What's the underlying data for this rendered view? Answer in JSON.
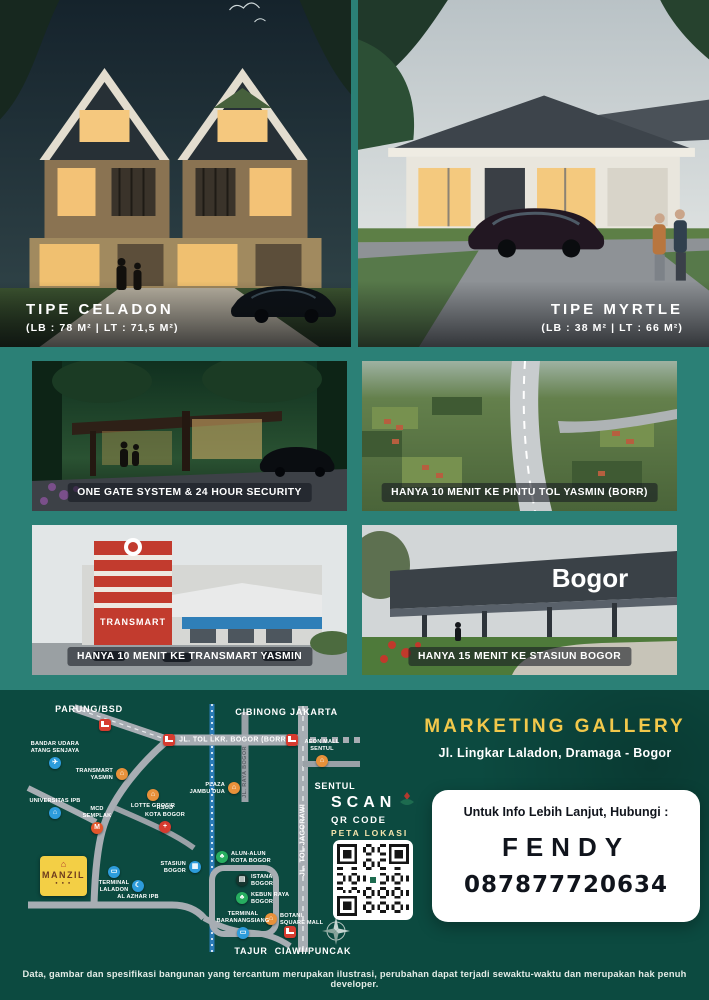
{
  "palette": {
    "teal_bg": "#2b8076",
    "panel_green": "#0c4a40",
    "accent_yellow": "#f2c84b",
    "toll_red": "#d63b2f",
    "poi_orange": "#e8913a",
    "poi_blue": "#2d9cdb",
    "poi_green": "#27ae60"
  },
  "hero": {
    "left": {
      "title": "TIPE CELADON",
      "spec": "(LB : 78 M² | LT : 71,5 M²)"
    },
    "right": {
      "title": "TIPE MYRTLE",
      "spec": "(LB : 38 M² | LT : 66 M²)"
    }
  },
  "features": [
    {
      "pre": "",
      "strong": "ONE GATE SYSTEM & 24 HOUR SECURITY",
      "post": ""
    },
    {
      "pre": "HANYA 10 MENIT KE ",
      "strong": "PINTU TOL YASMIN",
      "post": " (BORR)"
    },
    {
      "pre": "HANYA 10 MENIT KE ",
      "strong": "TRANSMART YASMIN",
      "post": ""
    },
    {
      "pre": "HANYA 15 MENIT KE ",
      "strong": "STASIUN BOGOR",
      "post": ""
    }
  ],
  "signs": {
    "station": "Bogor",
    "transmart": "TRANSMART"
  },
  "marketing": {
    "title": "MARKETING GALLERY",
    "address": "Jl. Lingkar Laladon, Dramaga - Bogor"
  },
  "scan": {
    "line1": "SCAN",
    "line2": "QR CODE",
    "line3": "PETA LOKASI"
  },
  "contact": {
    "label": "Untuk Info Lebih Lanjut, Hubungi :",
    "name": "FENDY",
    "phone": "087877720634"
  },
  "map": {
    "logo_text": "MANZIL",
    "area_labels": [
      {
        "text": "PARUNG/BSD",
        "x": 67,
        "y": 9
      },
      {
        "text": "CIBINONG",
        "x": 239,
        "y": 12
      },
      {
        "text": "JAKARTA",
        "x": 292,
        "y": 12
      },
      {
        "text": "SENTUL",
        "x": 313,
        "y": 86
      },
      {
        "text": "TAJUR",
        "x": 229,
        "y": 251
      },
      {
        "text": "CIAWI/PUNCAK",
        "x": 291,
        "y": 251
      }
    ],
    "road_labels": [
      {
        "text": "JL. TOL LKR. BOGOR (BORR)",
        "x": 212,
        "y": 40,
        "rot": false,
        "dark": false
      },
      {
        "text": "JL. RAYA BOGOR",
        "x": 223,
        "y": 72,
        "rot": true,
        "dark": true
      },
      {
        "text": "JL. TOL JAGORAWI",
        "x": 281,
        "y": 140,
        "rot": true,
        "dark": false
      }
    ],
    "pois": [
      {
        "id": "bandar-udara-atang-senjaya",
        "label": "BANDAR UDARA\nATANG SENJAYA",
        "glyph": "✈",
        "color": "#2d9cdb",
        "x": 33,
        "y": 63,
        "side": "top"
      },
      {
        "id": "transmart-yasmin",
        "label": "TRANSMART\nYASMIN",
        "glyph": "⌂",
        "color": "#e8913a",
        "x": 100,
        "y": 74,
        "side": "left"
      },
      {
        "id": "lotte-grosir",
        "label": "LOTTE GROSIR",
        "glyph": "⌂",
        "color": "#e8913a",
        "x": 131,
        "y": 95,
        "side": "bottom"
      },
      {
        "id": "plaza-jambu-dua",
        "label": "PLAZA\nJAMBU DUA",
        "glyph": "⌂",
        "color": "#e8913a",
        "x": 212,
        "y": 88,
        "side": "left"
      },
      {
        "id": "aeon-mall-sentul",
        "label": "AEON MALL\nSENTUL",
        "glyph": "⌂",
        "color": "#e8913a",
        "x": 300,
        "y": 61,
        "side": "top"
      },
      {
        "id": "universitas-ipb",
        "label": "UNIVERSITAS IPB",
        "glyph": "⌂",
        "color": "#2d9cdb",
        "x": 33,
        "y": 113,
        "side": "top"
      },
      {
        "id": "mcd-semplak",
        "label": "MCD\nSEMPLAK",
        "glyph": "M",
        "color": "#e2562b",
        "x": 75,
        "y": 128,
        "side": "top"
      },
      {
        "id": "rsud-kota-bogor",
        "label": "RSUD\nKOTA BOGOR",
        "glyph": "+",
        "color": "#d63b2f",
        "x": 143,
        "y": 127,
        "side": "top"
      },
      {
        "id": "stasiun-bogor",
        "label": "STASIUN\nBOGOR",
        "glyph": "▦",
        "color": "#2d9cdb",
        "x": 173,
        "y": 167,
        "side": "left"
      },
      {
        "id": "alun-alun-kota-bogor",
        "label": "ALUN-ALUN\nKOTA BOGOR",
        "glyph": "♣",
        "color": "#27ae60",
        "x": 200,
        "y": 157,
        "side": "right"
      },
      {
        "id": "terminal-laladon",
        "label": "TERMINAL\nLALADON",
        "glyph": "▭",
        "color": "#2d9cdb",
        "x": 92,
        "y": 172,
        "side": "bottom"
      },
      {
        "id": "al-azhar-ipb",
        "label": "AL AZHAR IPB",
        "glyph": "☾",
        "color": "#2d9cdb",
        "x": 116,
        "y": 186,
        "side": "bottom"
      },
      {
        "id": "istana-bogor",
        "label": "ISTANA\nBOGOR",
        "glyph": "▤",
        "color": "#16352f",
        "x": 220,
        "y": 180,
        "side": "right"
      },
      {
        "id": "kebun-raya-bogor",
        "label": "KEBUN RAYA\nBOGOR",
        "glyph": "♣",
        "color": "#27ae60",
        "x": 220,
        "y": 198,
        "side": "right"
      },
      {
        "id": "botani-square-mall",
        "label": "BOTANI\nSQUARE MALL",
        "glyph": "⌂",
        "color": "#e8913a",
        "x": 249,
        "y": 219,
        "side": "right"
      },
      {
        "id": "terminal-baranangsiang",
        "label": "TERMINAL\nBARANANGSIANG",
        "glyph": "▭",
        "color": "#2d9cdb",
        "x": 221,
        "y": 233,
        "side": "top"
      }
    ],
    "toll_gates": [
      {
        "x": 83,
        "y": 25
      },
      {
        "x": 147,
        "y": 40
      },
      {
        "x": 270,
        "y": 40
      },
      {
        "x": 268,
        "y": 232
      }
    ]
  },
  "disclaimer": "Data, gambar dan spesifikasi bangunan yang tercantum merupakan ilustrasi, perubahan dapat terjadi sewaktu-waktu dan merupakan hak penuh developer."
}
